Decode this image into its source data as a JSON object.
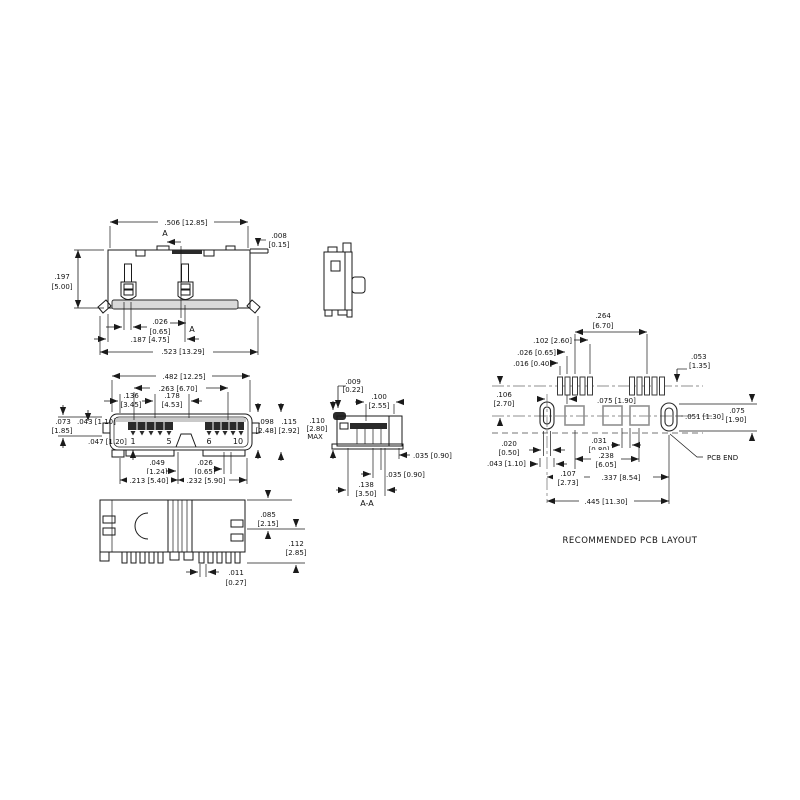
{
  "drawing": {
    "background": "#ffffff",
    "line_color": "#1a1a1a",
    "pad_gray": "#8f8f8f",
    "views": {
      "top": {
        "section_marker": "A",
        "dims": {
          "width": ".506 [12.85]",
          "lip_in": ".008",
          "lip_mm": "[0.15]",
          "height_in": ".197",
          "height_mm": "[5.00]",
          "post_in": ".026",
          "post_mm": "[0.65]",
          "offset": ".187 [4.75]",
          "overall": ".523 [13.29]"
        }
      },
      "front": {
        "pins": {
          "p1": "1",
          "p5": "5",
          "p6": "6",
          "p10": "10"
        },
        "dims": {
          "shell": ".482 [12.25]",
          "span": ".263 [6.70]",
          "d136_in": ".136",
          "d136_mm": "[3.45]",
          "d178_in": ".178",
          "d178_mm": "[4.53]",
          "d073_in": ".073",
          "d073_mm": "[1.85]",
          "d043": ".043 [1.10]",
          "d047": ".047 [1.20]",
          "d098_in": ".098",
          "d098_mm": "[2.48]",
          "d115_in": ".115",
          "d115_mm": "[2.92]",
          "d049_in": ".049",
          "d049_mm": "[1.24]",
          "d026_in": ".026",
          "d026_mm": "[0.65]",
          "d213": ".213 [5.40]",
          "d232": ".232 [5.90]"
        }
      },
      "section": {
        "label": "A-A",
        "dims": {
          "d009_in": ".009",
          "d009_mm": "[0.22]",
          "d100_in": ".100",
          "d100_mm": "[2.55]",
          "d110_in": ".110",
          "d110_mm": "[2.80]",
          "d110_max": "MAX",
          "d035_side": ".035 [0.90]",
          "d035_bottom": ".035 [0.90]",
          "d138_in": ".138",
          "d138_mm": "[3.50]"
        }
      },
      "bottom": {
        "dims": {
          "d085_in": ".085",
          "d085_mm": "[2.15]",
          "d112_in": ".112",
          "d112_mm": "[2.85]",
          "d011_in": ".011",
          "d011_mm": "[0.27]"
        }
      },
      "pcb": {
        "title": "RECOMMENDED PCB LAYOUT",
        "pcb_end": "PCB END",
        "dims": {
          "d264_in": ".264",
          "d264_mm": "[6.70]",
          "d102": ".102 [2.60]",
          "d026": ".026 [0.65]",
          "d016": ".016 [0.40]",
          "d053_in": ".053",
          "d053_mm": "[1.35]",
          "d106_in": ".106",
          "d106_mm": "[2.70]",
          "d075_top": ".075 [1.90]",
          "d051": ".051 [1.30]",
          "d075r_in": ".075",
          "d075r_mm": "[1.90]",
          "d020_in": ".020",
          "d020_mm": "[0.50]",
          "d043": ".043 [1.10]",
          "d031_in": ".031",
          "d031_mm": "[0.80]",
          "d238_in": ".238",
          "d238_mm": "[6.05]",
          "d107_in": ".107",
          "d107_mm": "[2.73]",
          "d337": ".337 [8.54]",
          "d445": ".445 [11.30]"
        }
      }
    }
  }
}
